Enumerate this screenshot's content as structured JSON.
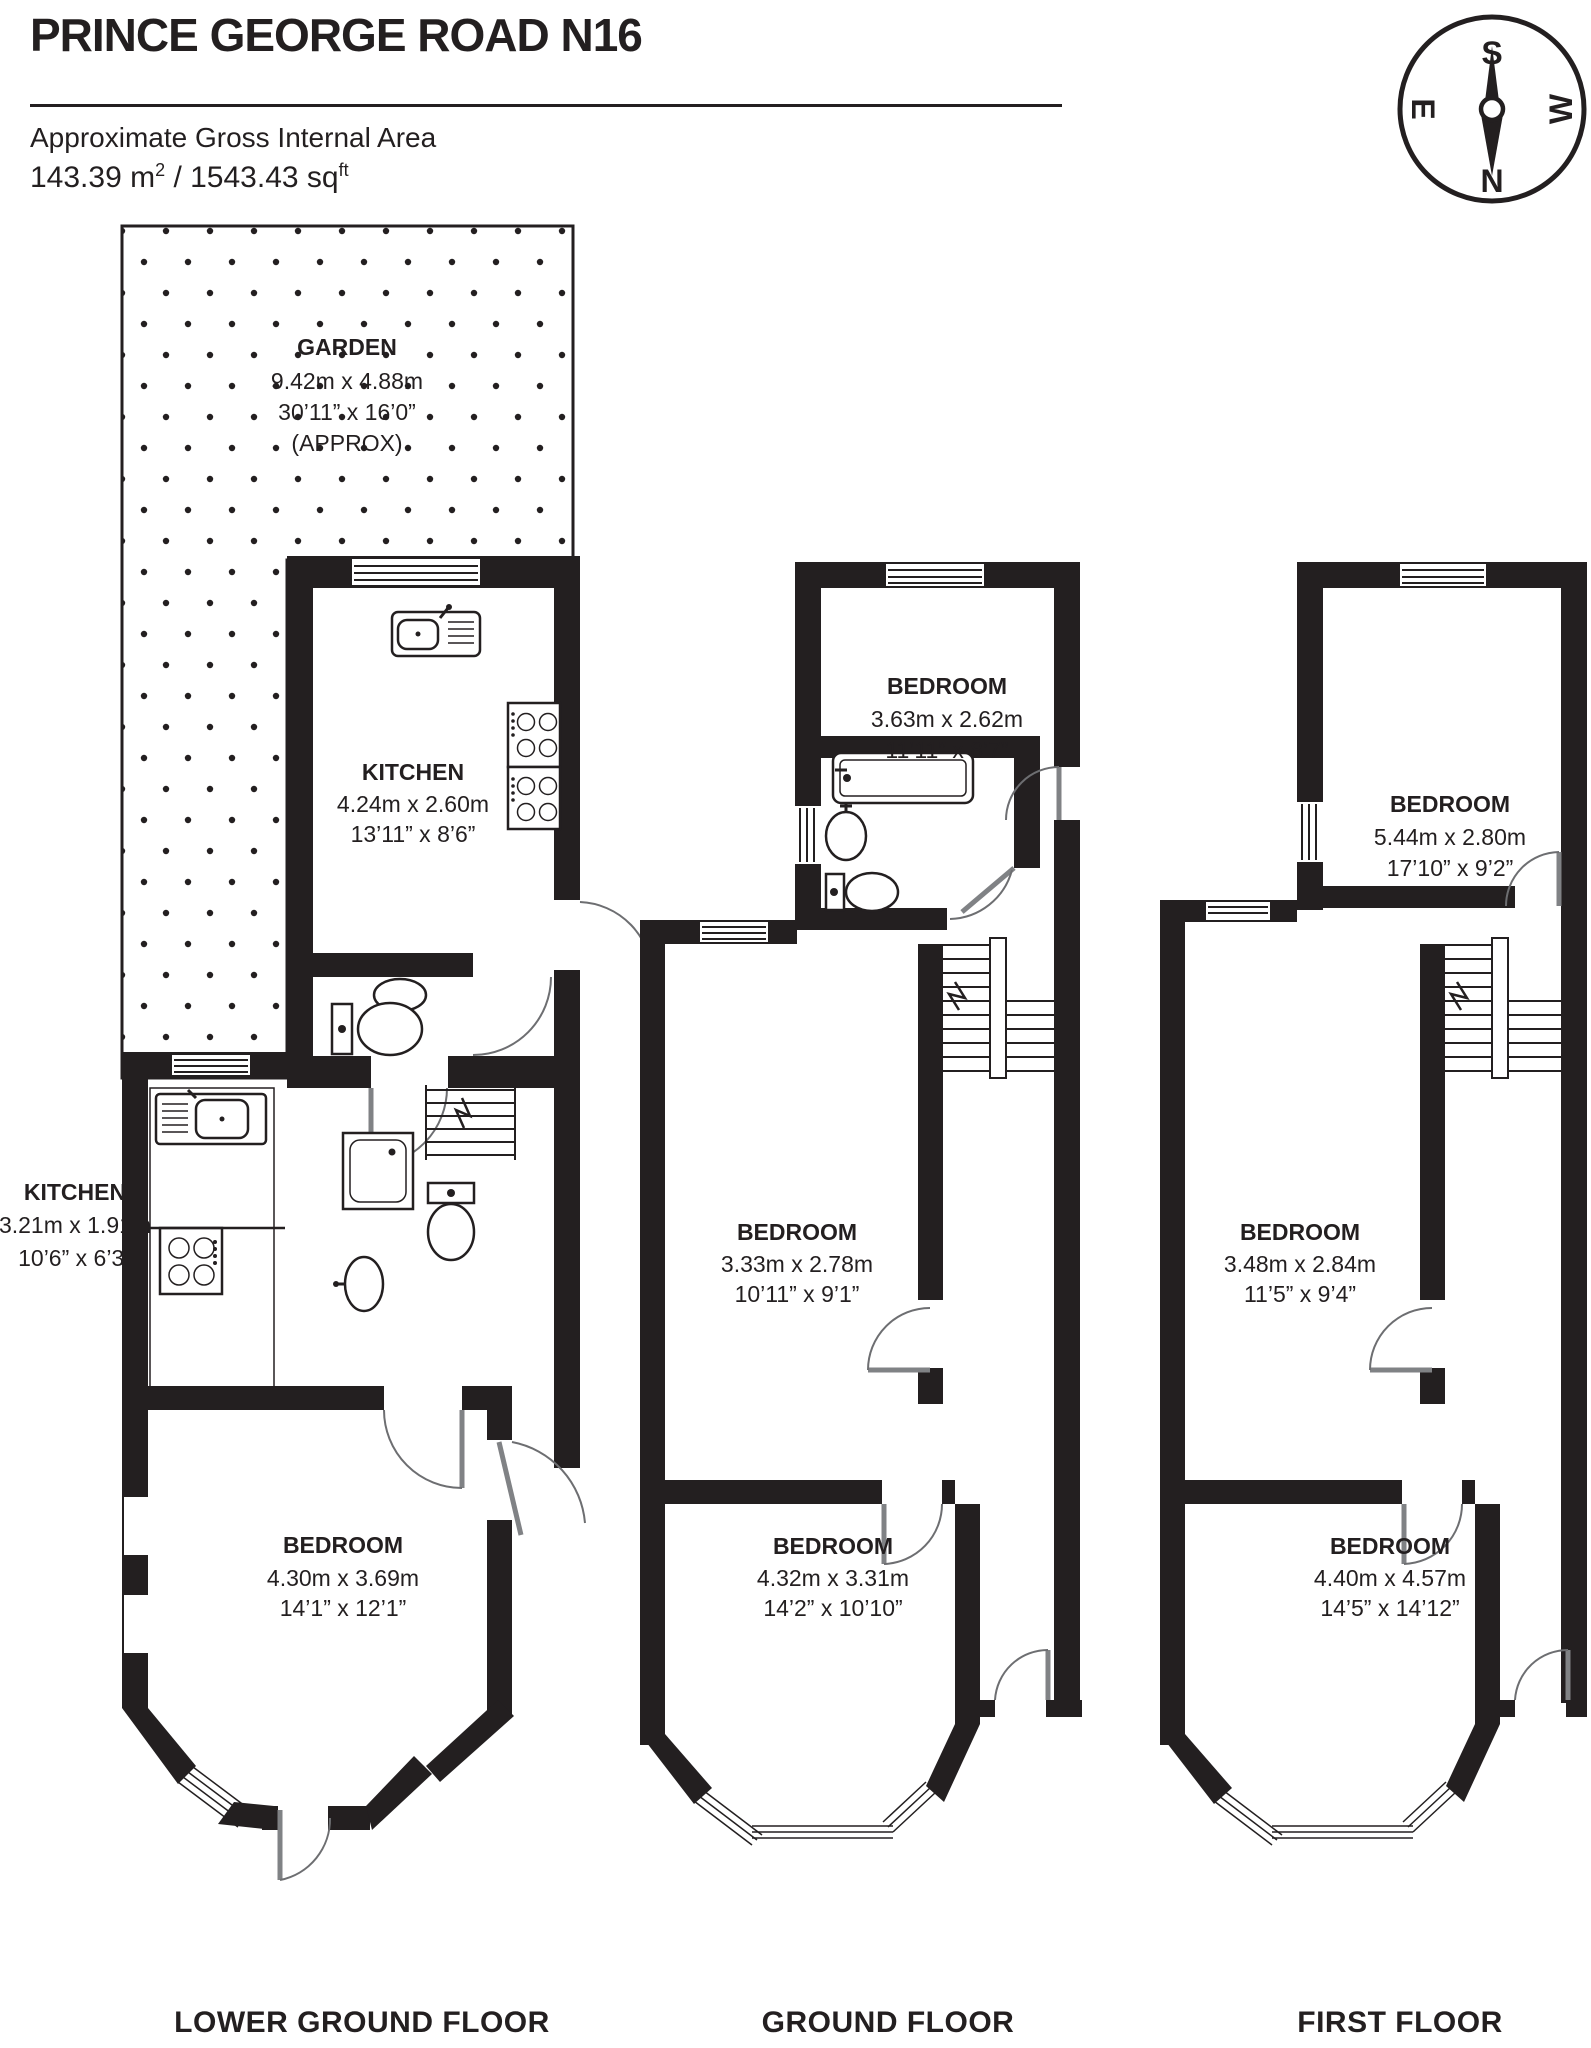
{
  "header": {
    "title": "PRINCE GEORGE ROAD N16",
    "subtitle": "Approximate Gross Internal Area",
    "area_metric": "143.39 m",
    "area_metric_sup": "2",
    "area_sep": " / ",
    "area_imperial": "1543.43 sq",
    "area_imperial_sup": "ft"
  },
  "compass": {
    "n": "N",
    "s": "S",
    "e": "E",
    "w": "W"
  },
  "floors": [
    {
      "name": "LOWER GROUND FLOOR",
      "rooms": [
        {
          "label": "GARDEN",
          "metric": "9.42m x 4.88m",
          "imperial": "30’11” x 16’0”",
          "note": "(APPROX)"
        },
        {
          "label": "KITCHEN",
          "metric": "4.24m x 2.60m",
          "imperial": "13’11” x 8’6”"
        },
        {
          "label": "KITCHEN",
          "metric": "3.21m x 1.91m",
          "imperial": "10’6” x 6’3”"
        },
        {
          "label": "BEDROOM",
          "metric": "4.30m x 3.69m",
          "imperial": "14’1” x 12’1”"
        }
      ]
    },
    {
      "name": "GROUND FLOOR",
      "rooms": [
        {
          "label": "BEDROOM",
          "metric": "3.63m x 2.62m",
          "imperial": "11’11” x 8’7”"
        },
        {
          "label": "BEDROOM",
          "metric": "3.33m x 2.78m",
          "imperial": "10’11” x 9’1”"
        },
        {
          "label": "BEDROOM",
          "metric": "4.32m x 3.31m",
          "imperial": "14’2” x 10’10”"
        }
      ]
    },
    {
      "name": "FIRST FLOOR",
      "rooms": [
        {
          "label": "BEDROOM",
          "metric": "5.44m x 2.80m",
          "imperial": "17’10” x 9’2”"
        },
        {
          "label": "BEDROOM",
          "metric": "3.48m x 2.84m",
          "imperial": "11’5” x 9’4”"
        },
        {
          "label": "BEDROOM",
          "metric": "4.40m x 4.57m",
          "imperial": "14’5” x 14’12”"
        }
      ]
    }
  ]
}
